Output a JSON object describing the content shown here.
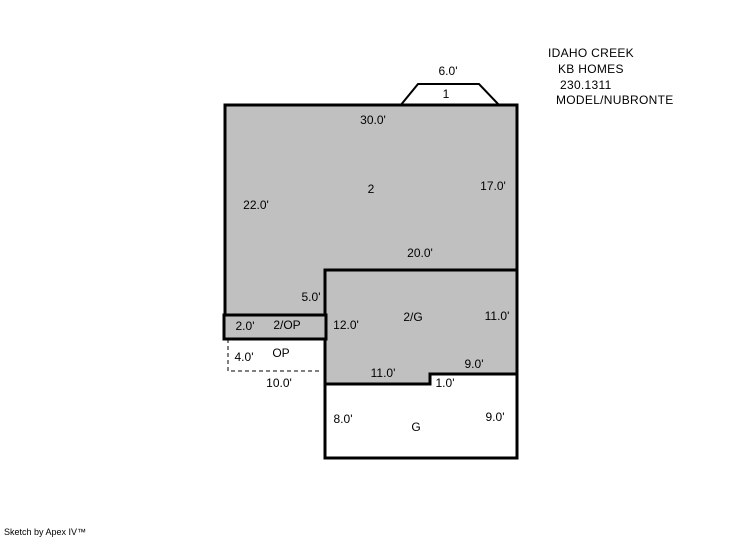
{
  "header": {
    "line1": "IDAHO CREEK",
    "line2": "KB HOMES",
    "line3": "230.1311",
    "line4": "MODEL/NUBRONTE"
  },
  "footer": {
    "credit": "Sketch by Apex IV™"
  },
  "colors": {
    "area_fill": "#c0c0c0",
    "outline": "#000000",
    "background": "#ffffff"
  },
  "floorplan": {
    "bay": {
      "area_label": "1",
      "width": "6.0'"
    },
    "main": {
      "area_label": "2",
      "top": "30.0'",
      "right": "17.0'",
      "left": "22.0'",
      "step": "5.0'"
    },
    "upper_garage": {
      "area_label": "2/G",
      "top": "20.0'",
      "left": "12.0'",
      "right": "11.0'",
      "bottom_left": "11.0'",
      "bottom_right": "9.0'",
      "notch": "1.0'"
    },
    "porch_strip": {
      "area_label": "2/OP",
      "height": "2.0'"
    },
    "open_porch": {
      "area_label": "OP",
      "height": "4.0'",
      "width": "10.0'"
    },
    "garage": {
      "area_label": "G",
      "left": "8.0'",
      "right": "9.0'"
    }
  }
}
